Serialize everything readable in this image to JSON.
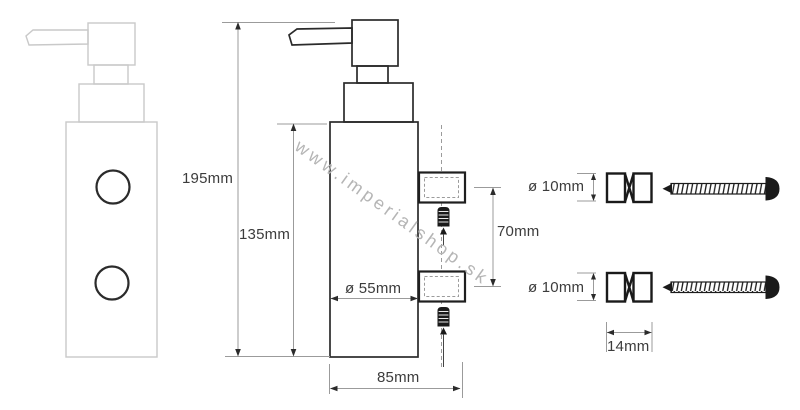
{
  "title": "soap-dispenser-technical-drawing",
  "watermark": {
    "text": "www.imperialshop.sk",
    "color": "#b5b5b5"
  },
  "colors": {
    "drawing_stroke": "#2b2b2b",
    "ghost_stroke": "#c9c9c9",
    "dimension_line": "#9b9b9b",
    "label_text": "#3c3c3c",
    "hardware_fill": "#1a1a1a",
    "background": "#ffffff"
  },
  "dimensions": {
    "total_height": "195mm",
    "body_height": "135mm",
    "body_diameter": "ø 55mm",
    "base_depth": "85mm",
    "bracket_spacing": "70mm",
    "peg_diameter_top": "ø 10mm",
    "peg_diameter_bottom": "ø 10mm",
    "peg_length": "14mm"
  }
}
